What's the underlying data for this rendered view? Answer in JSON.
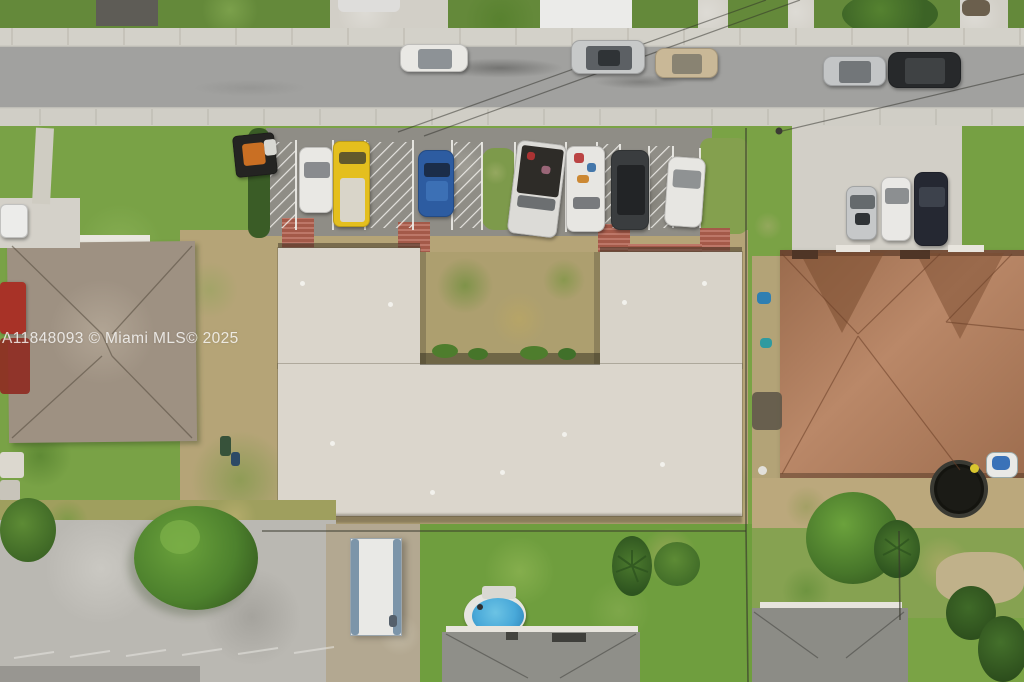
{
  "meta": {
    "type": "aerial-drone-photo",
    "description": "Top-down aerial real-estate photo of a U-shaped flat-roof multifamily building with front parking stalls, a street with parallel-parked cars at top, neighboring single-family homes left and right, backyard pool, trampoline and lawns below"
  },
  "watermark": {
    "text": "A11848093 © Miami MLS© 2025"
  },
  "palette": {
    "lawn_green": "#76a144",
    "dry_grass_tan": "#b5a477",
    "road_asphalt": "#a1a19f",
    "parking_asphalt": "#8f8d86",
    "sidewalk_concrete": "#d2d0c8",
    "flat_roof_gray": "#dad5cb",
    "left_roof_taupe": "#9e9182",
    "right_roof_terracotta": "#b37c59",
    "bottom_roof_gray": "#8f8f89",
    "brick_walkway_red": "#b2614f",
    "pool_blue": "#49a9d9",
    "trampoline_black": "#23231f",
    "yellow_van": "#e4bf1e",
    "blue_car": "#2d5ca1",
    "marking_white": "#f4f3ef"
  },
  "scene_objects": [
    "street",
    "upper-sidewalk",
    "lower-sidewalk",
    "parallel-parked-cars",
    "parking-stalls",
    "no-parking-hatch-zones",
    "skid-steer-loader",
    "u-shaped-flat-roof-building",
    "courtyard",
    "brick-walkways",
    "left-house-roof",
    "right-house-roof",
    "right-driveway-cars",
    "bottom-parking-lot",
    "utility-trailer",
    "above-ground-pool",
    "bottom-center-house",
    "bottom-right-house",
    "trampoline",
    "jet-ski",
    "trees",
    "hedges",
    "fence-lines",
    "power-lines",
    "watermark"
  ]
}
